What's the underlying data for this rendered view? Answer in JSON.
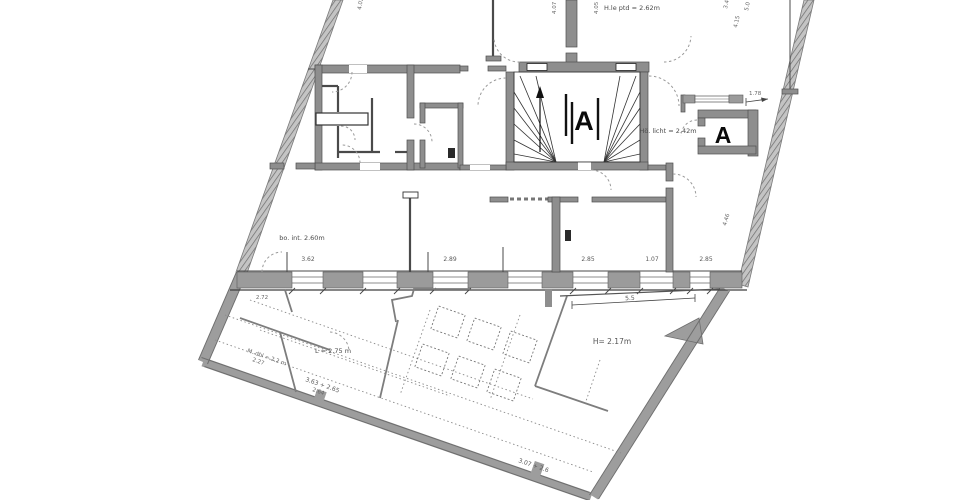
{
  "stairwell": {
    "label": "A",
    "height_note": "Hö. licht = 2.42m"
  },
  "shaft": {
    "label": "A"
  },
  "notes": {
    "top_ceiling": "H.le ptd = 2.62m",
    "left_room": "bo. int. 2.60m",
    "hall_height": "H= 2.17m",
    "length_note": "L = 2.75 m",
    "cellar_1": "M. dbl = 2.2 m",
    "cellar_2": "2.27",
    "cellar_3": "3.63 + 2.65",
    "cellar_4": "2.64",
    "cellar_5": "3.07 + 2.6"
  },
  "dims": {
    "win1": "3.62",
    "win2": "2.89",
    "win3": "2.85",
    "win4": "1.07",
    "win5": "2.85",
    "low": "2.72",
    "v1": "4.02",
    "v2": "4.07",
    "v3": "4.05",
    "v4": "3.4",
    "v5": "5.0",
    "v6": "4.15",
    "v7": "4.46",
    "lintel": "1.78",
    "span": "5.5"
  },
  "colors": {
    "wall_gray": "#8e8e8e",
    "hatch_gray": "#c2c2c2",
    "line_dark": "#4a4a4a"
  }
}
